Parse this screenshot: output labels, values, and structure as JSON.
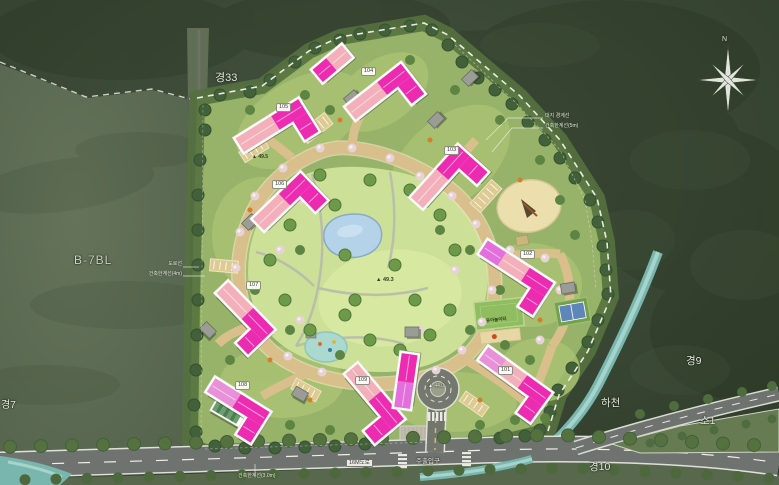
{
  "map": {
    "block_label": "B-7BL",
    "roads": {
      "northwest": "경33",
      "southwest": "경7",
      "east": "경9",
      "south": "경10",
      "island": "소1",
      "width_label": "16M도로"
    },
    "stream_label": "하천",
    "entrance_label": "주출입구",
    "compass": "N",
    "annotations": {
      "site_boundary": "대지 경계선",
      "building_limit_5m": "건축한계선(5m)",
      "road_line": "도로선",
      "building_limit_4m": "건축한계선(4m)",
      "building_limit_3m": "건축한계선(3.0m)"
    },
    "elevations": {
      "park": "▲ 49.3",
      "upper": "▲ 49.5",
      "roundabout": "▲ 44.0"
    },
    "playground_label": "유아놀이터",
    "buildings": [
      {
        "label": "101"
      },
      {
        "label": "102"
      },
      {
        "label": "103"
      },
      {
        "label": "104"
      },
      {
        "label": "105"
      },
      {
        "label": "106"
      },
      {
        "label": "107"
      },
      {
        "label": "108"
      },
      {
        "label": "109"
      }
    ],
    "colors": {
      "forest": "#36432f",
      "field": "#5c6b52",
      "site_green": "#97b369",
      "park_lawn": "#cde098",
      "internal_road": "#d9bf8b",
      "asphalt": "#6f7370",
      "stream": "#79b7ae",
      "pond": "#b5d3e8",
      "building_pink": "#f3b0ba",
      "building_magenta": "#ec2bb1",
      "building_violet": "#e26fdc"
    }
  }
}
